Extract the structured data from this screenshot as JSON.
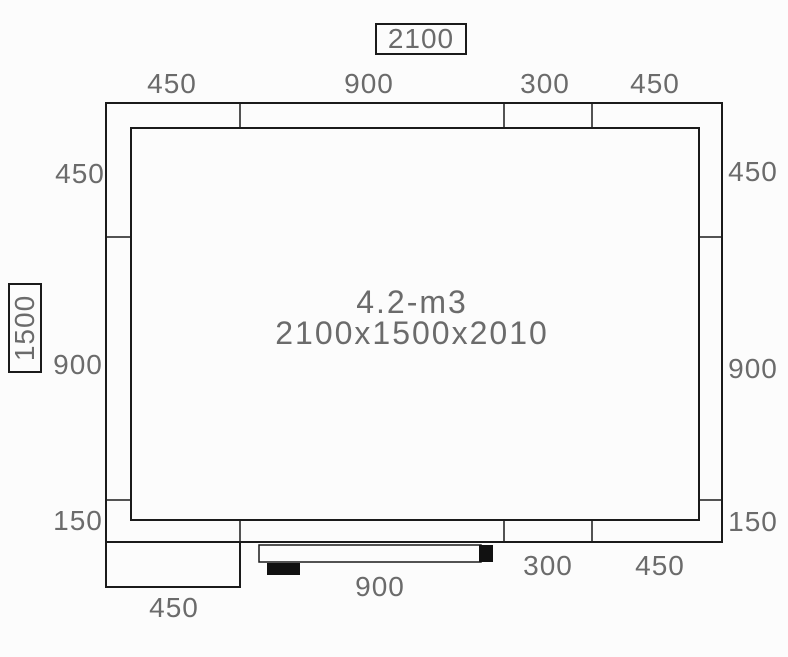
{
  "drawing": {
    "type_label": "cold-room floor plan",
    "overall_width_label": "2100",
    "overall_depth_label": "1500",
    "room": {
      "volume_label": "4.2-m3",
      "size_label": "2100x1500x2010"
    },
    "dimensions": {
      "top": [
        "450",
        "900",
        "300",
        "450"
      ],
      "left": [
        "450",
        "900",
        "150"
      ],
      "right": [
        "450",
        "900",
        "150"
      ],
      "bottom": [
        "900",
        "300",
        "450"
      ],
      "bottom_left": "450"
    },
    "colors": {
      "line": "#1b1b1b",
      "dim_text": "#6b6b6b",
      "door_fill": "#111111",
      "background": "#fcfcfc"
    }
  }
}
